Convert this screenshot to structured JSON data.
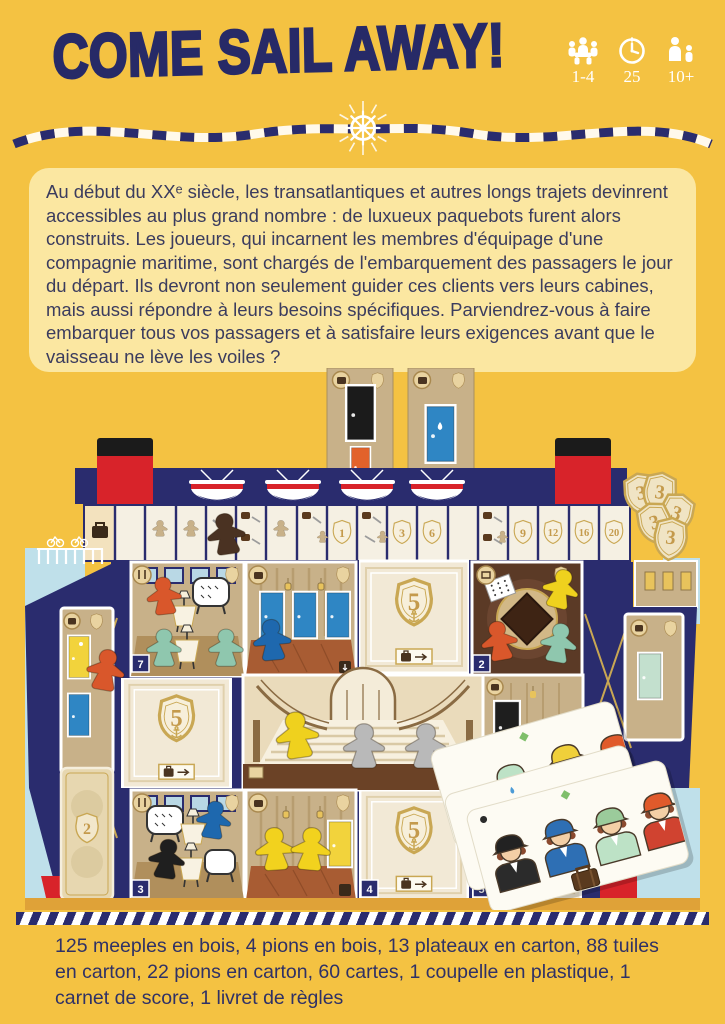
{
  "header": {
    "title": "COME SAIL AWAY!",
    "stats": [
      {
        "name": "players",
        "label": "1-4"
      },
      {
        "name": "duration-minutes",
        "label": "25"
      },
      {
        "name": "age",
        "label": "10+"
      }
    ]
  },
  "intro": {
    "text": "Au début du XXᵉ siècle, les transatlantiques et autres longs trajets devinrent accessibles au plus grand nombre : de luxueux paquebots furent alors construits. Les joueurs, qui incarnent les membres d'équipage d'une compagnie maritime, sont chargés de l'embarquement des passagers le jour du départ. Ils devront non seulement guider ces clients vers leurs cabines, mais aussi répondre à leurs besoins spécifiques. Parviendrez-vous à faire embarquer tous vos passagers et à satisfaire leurs exigences avant que le vaisseau ne lève les voiles ?"
  },
  "board": {
    "track": [
      "1",
      "3",
      "6",
      "9",
      "12",
      "16",
      "20"
    ],
    "token_value": "3",
    "facedown_value": "5",
    "hull_card_value": "2",
    "tile_tabs": [
      "7",
      "2",
      "3",
      "4",
      "5"
    ]
  },
  "footer": {
    "components": "125 meeples en bois, 4 pions en bois, 13 plateaux en carton, 88 tuiles en carton, 22 pions en carton, 60 cartes, 1 coupelle en plastique, 1 carnet de score, 1 livret de règles"
  },
  "colors": {
    "navy": "#2A2C6E",
    "yellow": "#F4C242",
    "cream_box": "#FBE7A1",
    "gold": "#C9A753",
    "red": "#D8232A"
  }
}
